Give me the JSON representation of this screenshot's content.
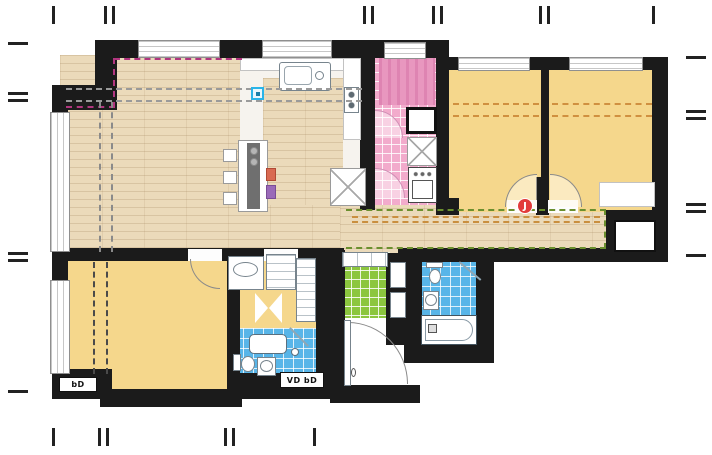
{
  "floor_plan": {
    "type": "apartment-floor-plan",
    "labels": {
      "duct_label_master": "bD",
      "duct_label_bath": "VD bD"
    },
    "markers": {
      "door_marker_glyph": "J"
    },
    "colors": {
      "wall": "#1b1b1b",
      "wood_floor": "#ebdaba",
      "bedroom_yellow": "#f5d78c",
      "utility_pink": "#f2abcc",
      "entry_green": "#8cc63e",
      "bathroom_blue": "#58b5e8",
      "zone_dashed_magenta": "#b1367f",
      "zone_dashed_gray": "#999999",
      "zone_dashed_orange": "#c98f3f",
      "zone_dashed_green": "#6b8f2e",
      "marker_red": "#e23b3b",
      "marker_cyan": "#2ab4e8"
    },
    "rooms": [
      {
        "name": "living-dining-room",
        "floor": "wood"
      },
      {
        "name": "kitchen",
        "floor": "white"
      },
      {
        "name": "utility-room",
        "floor": "pink-tile"
      },
      {
        "name": "bedroom-1",
        "floor": "yellow"
      },
      {
        "name": "bedroom-2",
        "floor": "yellow"
      },
      {
        "name": "master-bedroom",
        "floor": "yellow"
      },
      {
        "name": "dressing-room",
        "floor": "yellow"
      },
      {
        "name": "bathroom-ensuite",
        "floor": "blue-tile"
      },
      {
        "name": "bathroom-main",
        "floor": "blue-tile"
      },
      {
        "name": "entry-hall",
        "floor": "green-tile"
      },
      {
        "name": "hallway",
        "floor": "wood"
      }
    ]
  }
}
